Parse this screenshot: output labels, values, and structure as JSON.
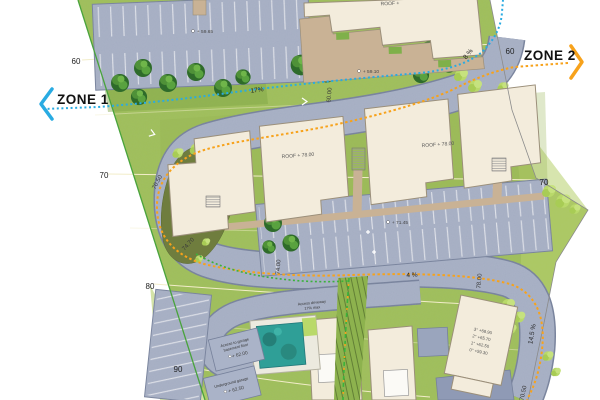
{
  "zones": {
    "zone1": "ZONE 1",
    "zone2": "ZONE 2"
  },
  "contours": {
    "left_60": "60",
    "right_60": "60",
    "left_70": "70",
    "right_70": "70",
    "left_80": "80",
    "left_90": "90"
  },
  "grades": {
    "top17": "17%",
    "right8": "8 %",
    "mid4": "4 %",
    "br145": "14.5 %"
  },
  "road_elev": {
    "e1": "60.00",
    "e2": "70.50",
    "e3": "74.70",
    "e4": "74.00",
    "e5": "78.00",
    "e6": "70.50"
  },
  "buildings": {
    "roof_top": "ROOF +",
    "roof_a": "ROOF + 78.00",
    "roof_b": "ROOF + 78.00",
    "floors": [
      "3° +68.90",
      "2° +65.70",
      "1° +62.50",
      "0° +59.30"
    ]
  },
  "spots": {
    "s5965": "+ 59.65",
    "s5910": "+ 59.10",
    "s7145": "+ 71.45"
  },
  "notes": {
    "access1": "Access driveway",
    "access2": "17% max",
    "garage1": "Access to garage",
    "garage2": "basement floor",
    "garage_elev": "+ 62.00",
    "under1": "Underground garage",
    "under_elev": "+ 62.50"
  },
  "colors": {
    "asphalt": "#aab3c8",
    "grass": "#a0bf5b",
    "building": "#f3ecdc",
    "terrace": "#c9b295",
    "pool": "#2f9f97",
    "zone1_accent": "#29abe2",
    "zone2_accent": "#f7a21b",
    "boundary_green": "#49a33c"
  }
}
